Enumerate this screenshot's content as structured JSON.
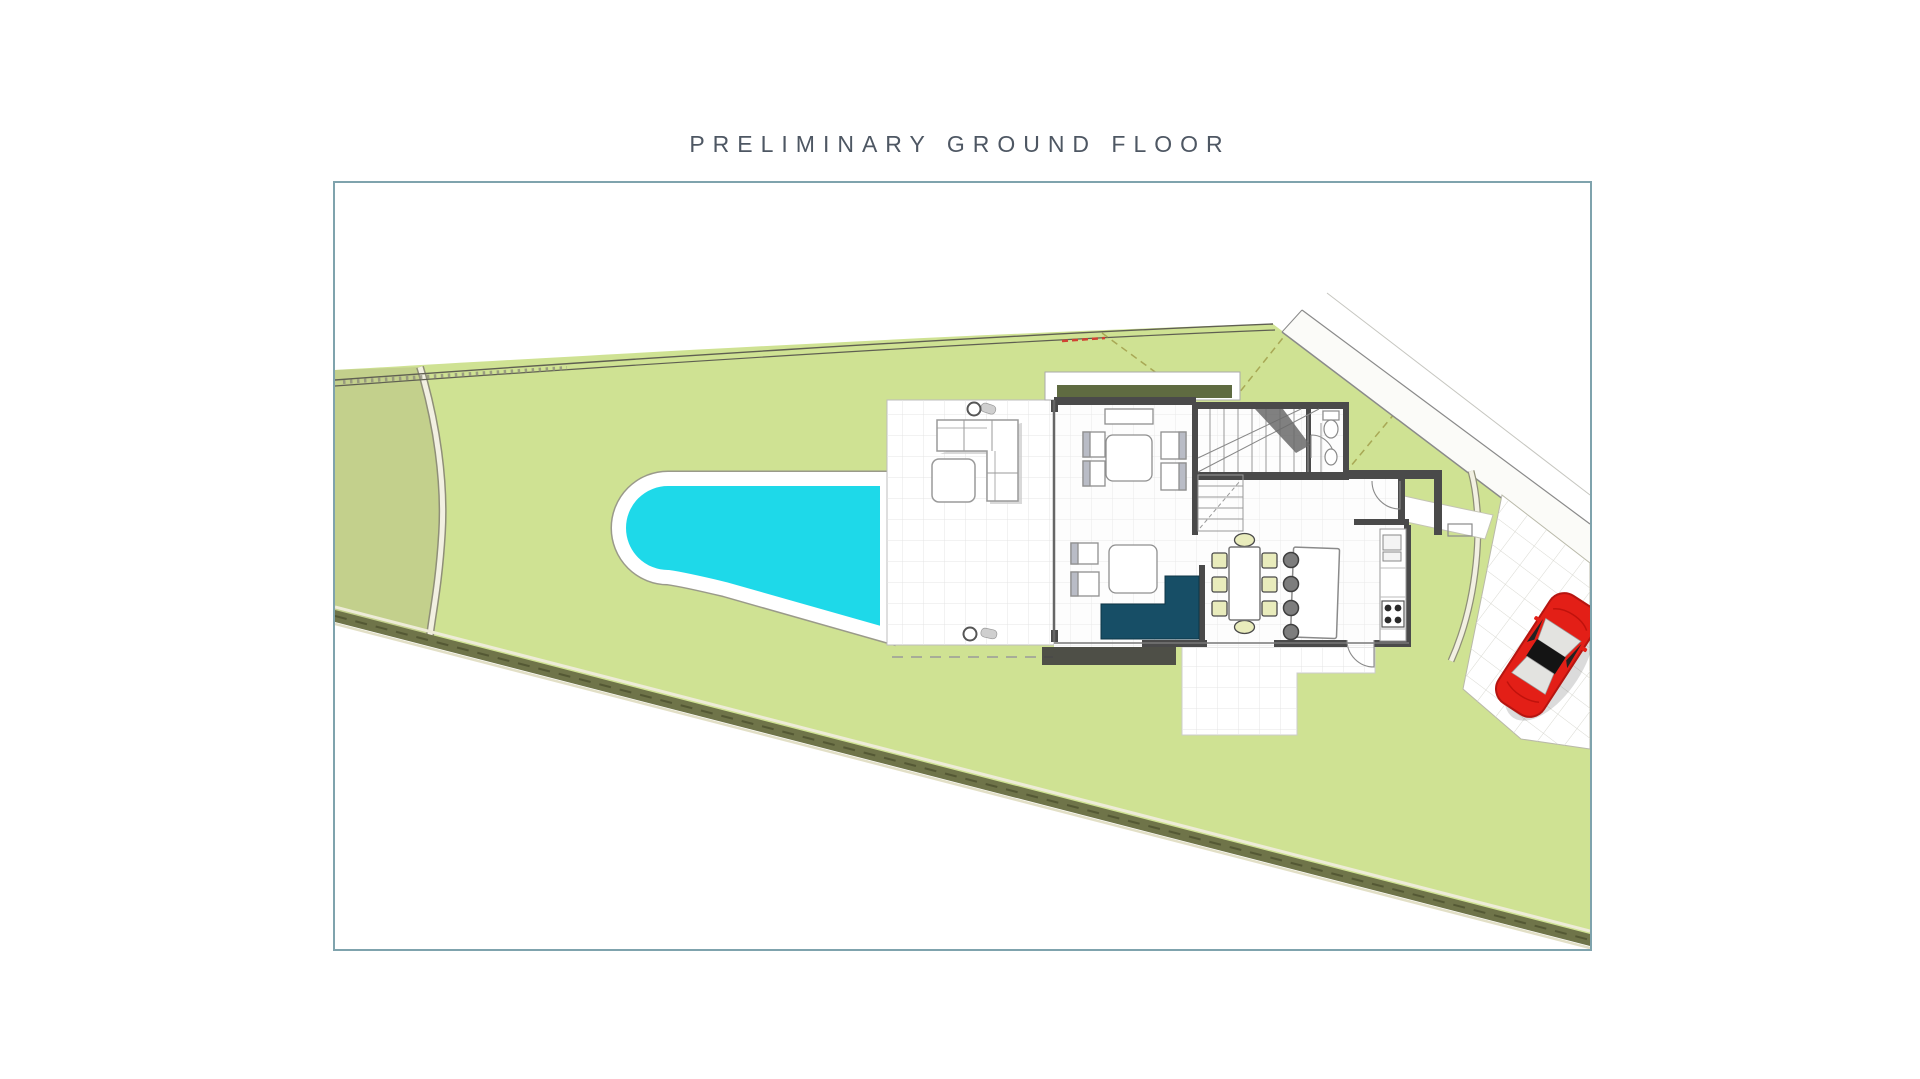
{
  "title": "PRELIMINARY GROUND FLOOR",
  "colors": {
    "title_text": "#4e5763",
    "frame_border": "#7fa3ad",
    "grass_main": "#cfe293",
    "grass_left": "#c3d08c",
    "pool_water": "#1ed9e9",
    "pool_deck": "#ffffff",
    "boundary_band": "#6f7449",
    "house_wall": "#4a4a4a",
    "roof_band_olive": "#5f6b41",
    "sofa_navy": "#174e66",
    "dining_chair": "#e9ecbc",
    "stool_gray": "#7d7d7d",
    "car_red": "#e31f17"
  },
  "plan": {
    "elements": [
      "garden-plot",
      "boundary-road",
      "boundary-hedge",
      "swimming-pool",
      "pool-terrace",
      "villa-ground-floor",
      "staircase",
      "bathroom",
      "living-room",
      "dining-table",
      "kitchen-island",
      "kitchen-counter",
      "entrance-path",
      "driveway",
      "parked-car",
      "south-patio"
    ]
  }
}
